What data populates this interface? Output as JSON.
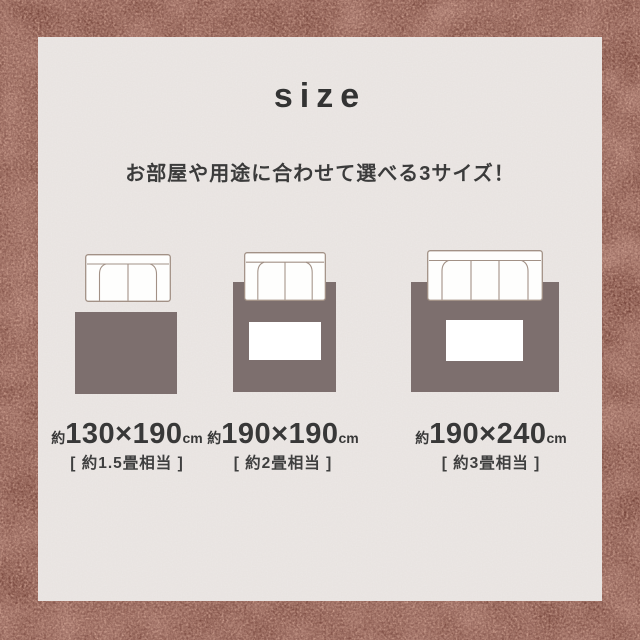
{
  "header": {
    "title": "size",
    "subtitle": "お部屋や用途に合わせて選べる3サイズ！"
  },
  "options": [
    {
      "approx": "約",
      "dimensions": "130×190",
      "unit": "cm",
      "equivalent": "[ 約1.5畳相当 ]",
      "sofa_seats": 2,
      "sofa_overlaps_rug": false,
      "has_center_table": false
    },
    {
      "approx": "約",
      "dimensions": "190×190",
      "unit": "cm",
      "equivalent": "[ 約2畳相当 ]",
      "sofa_seats": 2,
      "sofa_overlaps_rug": true,
      "has_center_table": true
    },
    {
      "approx": "約",
      "dimensions": "190×240",
      "unit": "cm",
      "equivalent": "[ 約3畳相当 ]",
      "sofa_seats": 3,
      "sofa_overlaps_rug": true,
      "has_center_table": true
    }
  ],
  "colors": {
    "carpet_border": "#6e3c32",
    "panel_background": "#e8e3e0",
    "rug_illustration": "#7d6f6e",
    "sofa_outline": "#a29186",
    "text": "#383838"
  }
}
